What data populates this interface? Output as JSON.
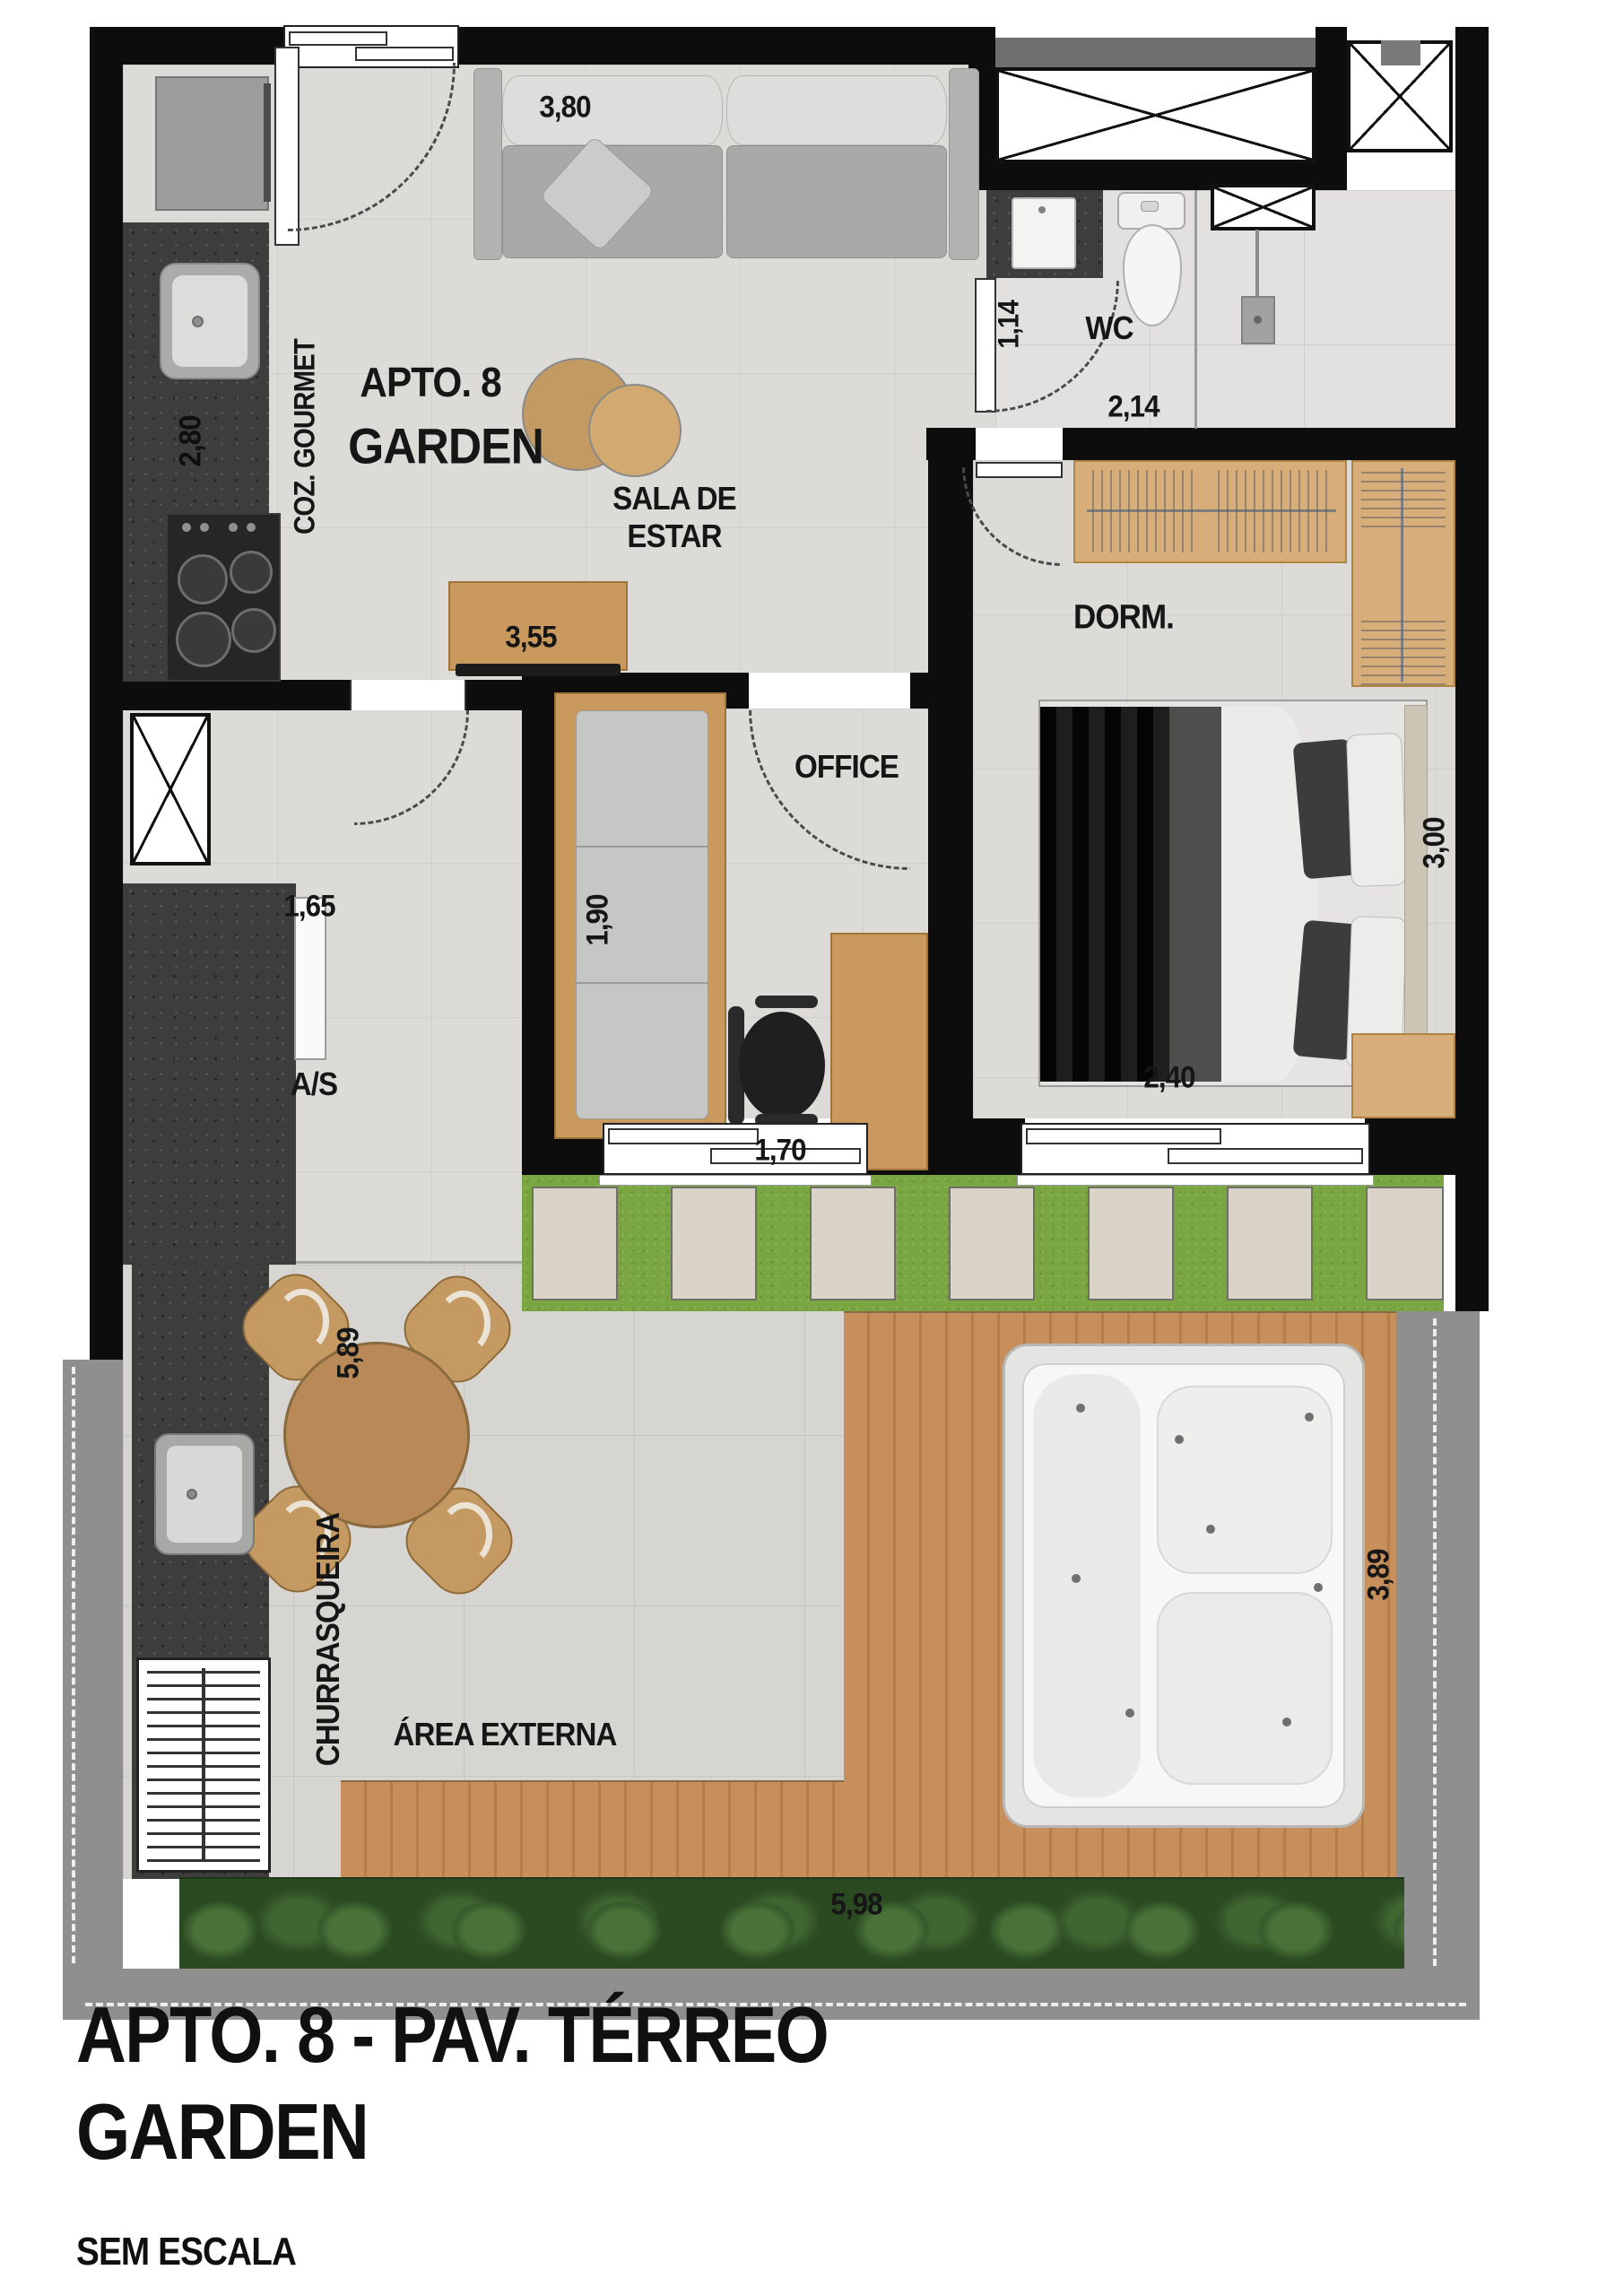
{
  "title": {
    "apto": "APTO. 8",
    "garden": "GARDEN"
  },
  "rooms": {
    "coz_gourmet": "COZ. GOURMET",
    "sala_l1": "SALA DE",
    "sala_l2": "ESTAR",
    "wc": "WC",
    "dorm": "DORM.",
    "office": "OFFICE",
    "servico": "A/S",
    "churrasqueira": "CHURRASQUEIRA",
    "area_externa": "ÁREA EXTERNA"
  },
  "dimensions": {
    "sofa_wall": "3,80",
    "kitchen_counter": "2,80",
    "tv_console": "3,55",
    "hall": "1,14",
    "wc_width": "2,14",
    "bedroom_depth": "3,00",
    "bedroom_window": "2,40",
    "office_sofa": "1,90",
    "office_width": "1,70",
    "servico_width": "1,65",
    "externa_depth": "5,89",
    "deck_width": "3,89",
    "externa_width": "5,98"
  },
  "caption": {
    "line1": "APTO. 8 - PAV. TÉRREO",
    "line2": "GARDEN",
    "scale_note": "SEM ESCALA"
  }
}
